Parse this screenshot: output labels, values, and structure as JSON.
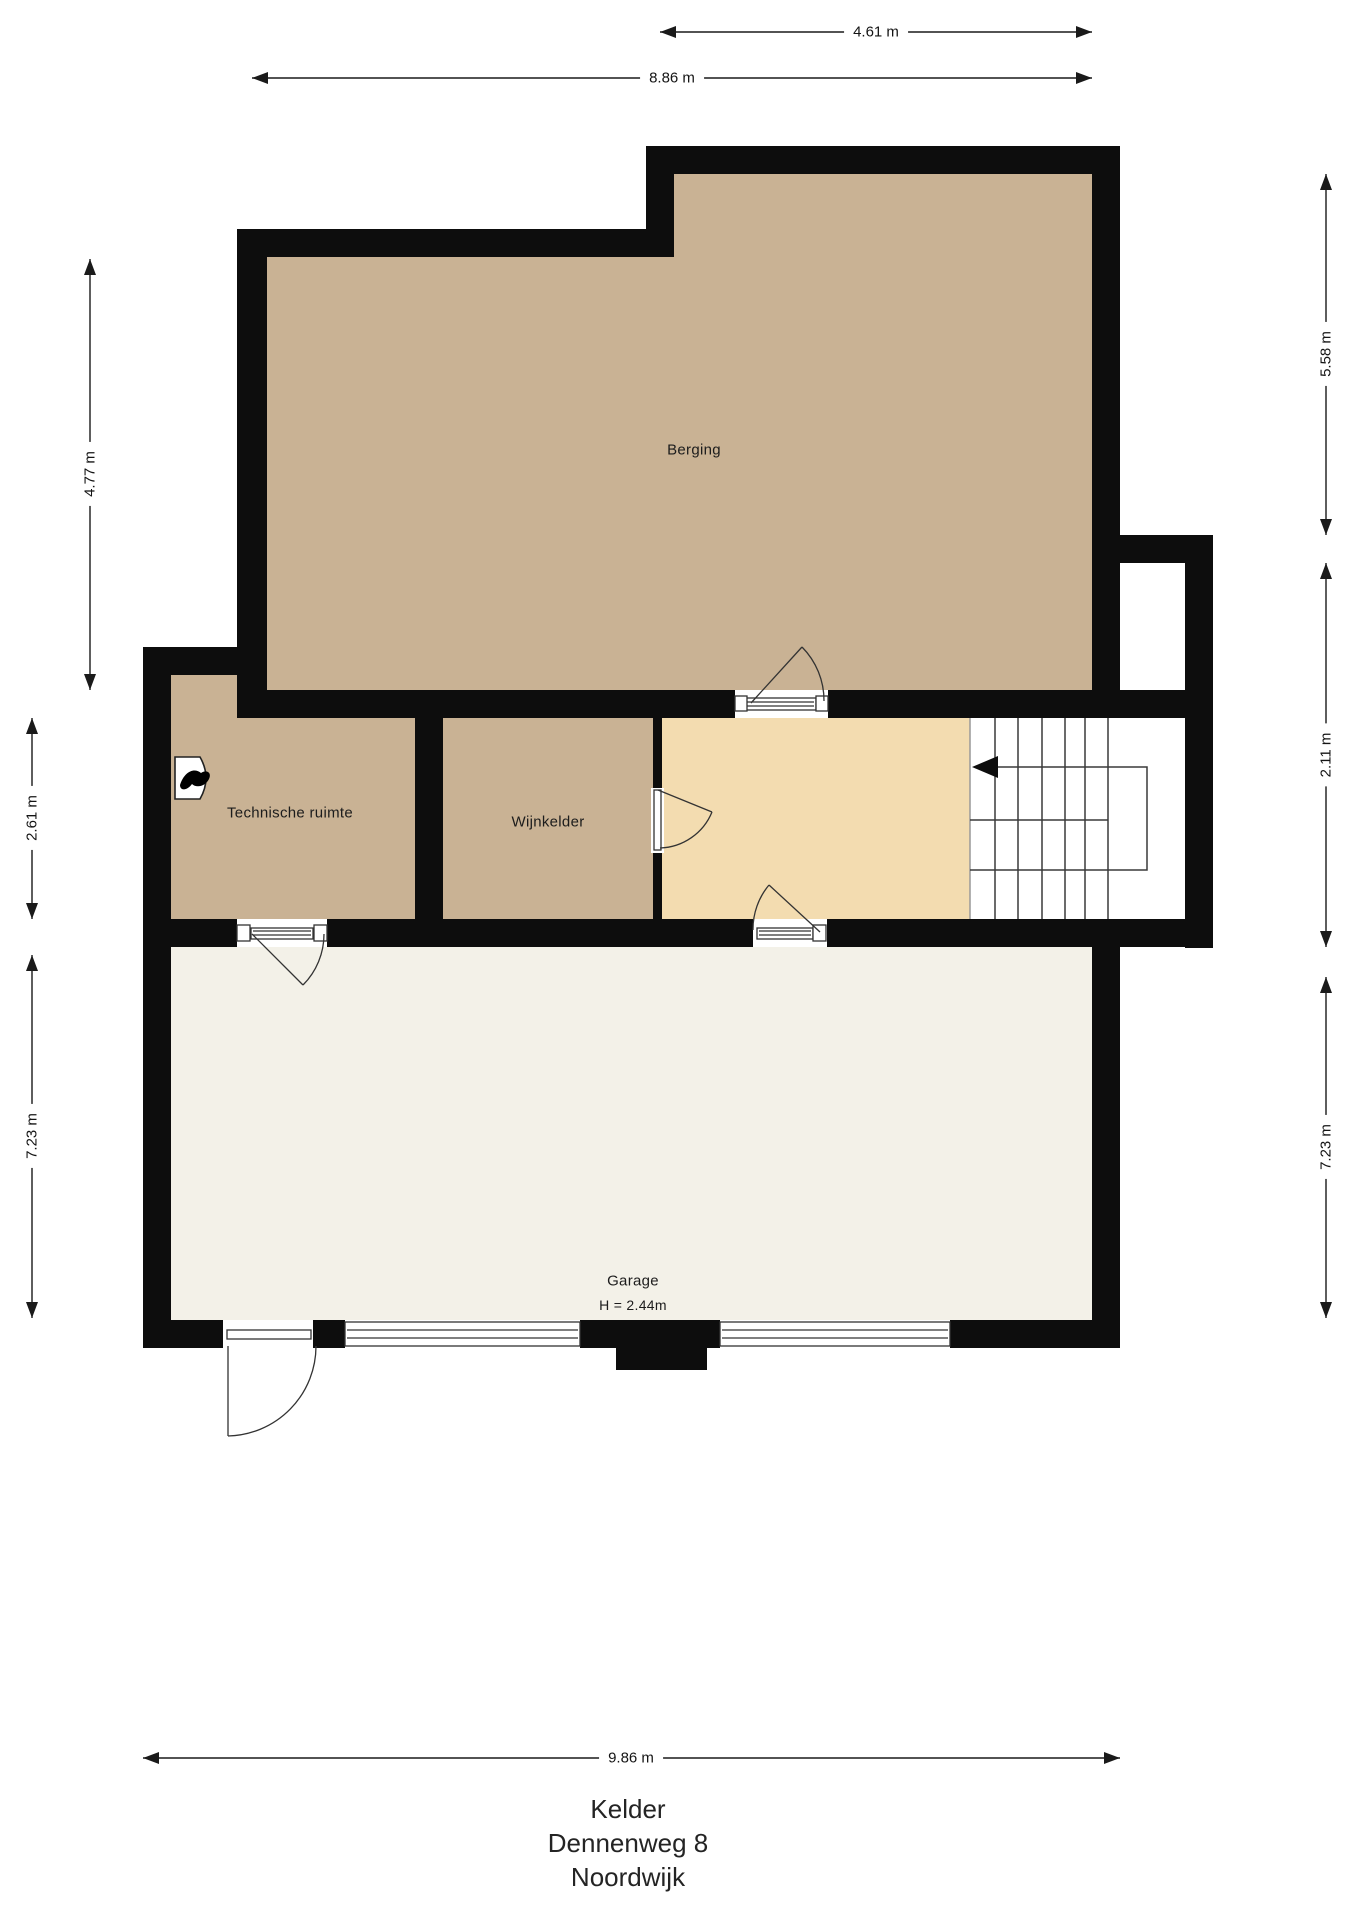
{
  "plan": {
    "rooms": [
      {
        "label": "Berging"
      },
      {
        "label": "Technische ruimte"
      },
      {
        "label": "Wijnkelder"
      },
      {
        "label": "Garage",
        "height_note": "H = 2.44m"
      }
    ],
    "dimensions": {
      "top_partial": "4.61 m",
      "top_full": "8.86 m",
      "left_berging": "4.77 m",
      "left_middle_row": "2.61 m",
      "left_garage": "7.23 m",
      "right_berging": "5.58 m",
      "right_stair_section": "2.11 m",
      "right_garage": "7.23 m",
      "bottom_garage": "9.86 m"
    },
    "title": {
      "floor": "Kelder",
      "street": "Dennenweg 8",
      "city": "Noordwijk"
    },
    "icons": {
      "boiler_unit": "flame-icon",
      "stair_direction": "left-arrow"
    },
    "colors": {
      "wall": "#0d0d0d",
      "storage_floor": "#c9b294",
      "hall_floor": "#f3dcb0",
      "garage_floor": "#f3f1e8",
      "stairs_floor": "#ffffff"
    }
  }
}
